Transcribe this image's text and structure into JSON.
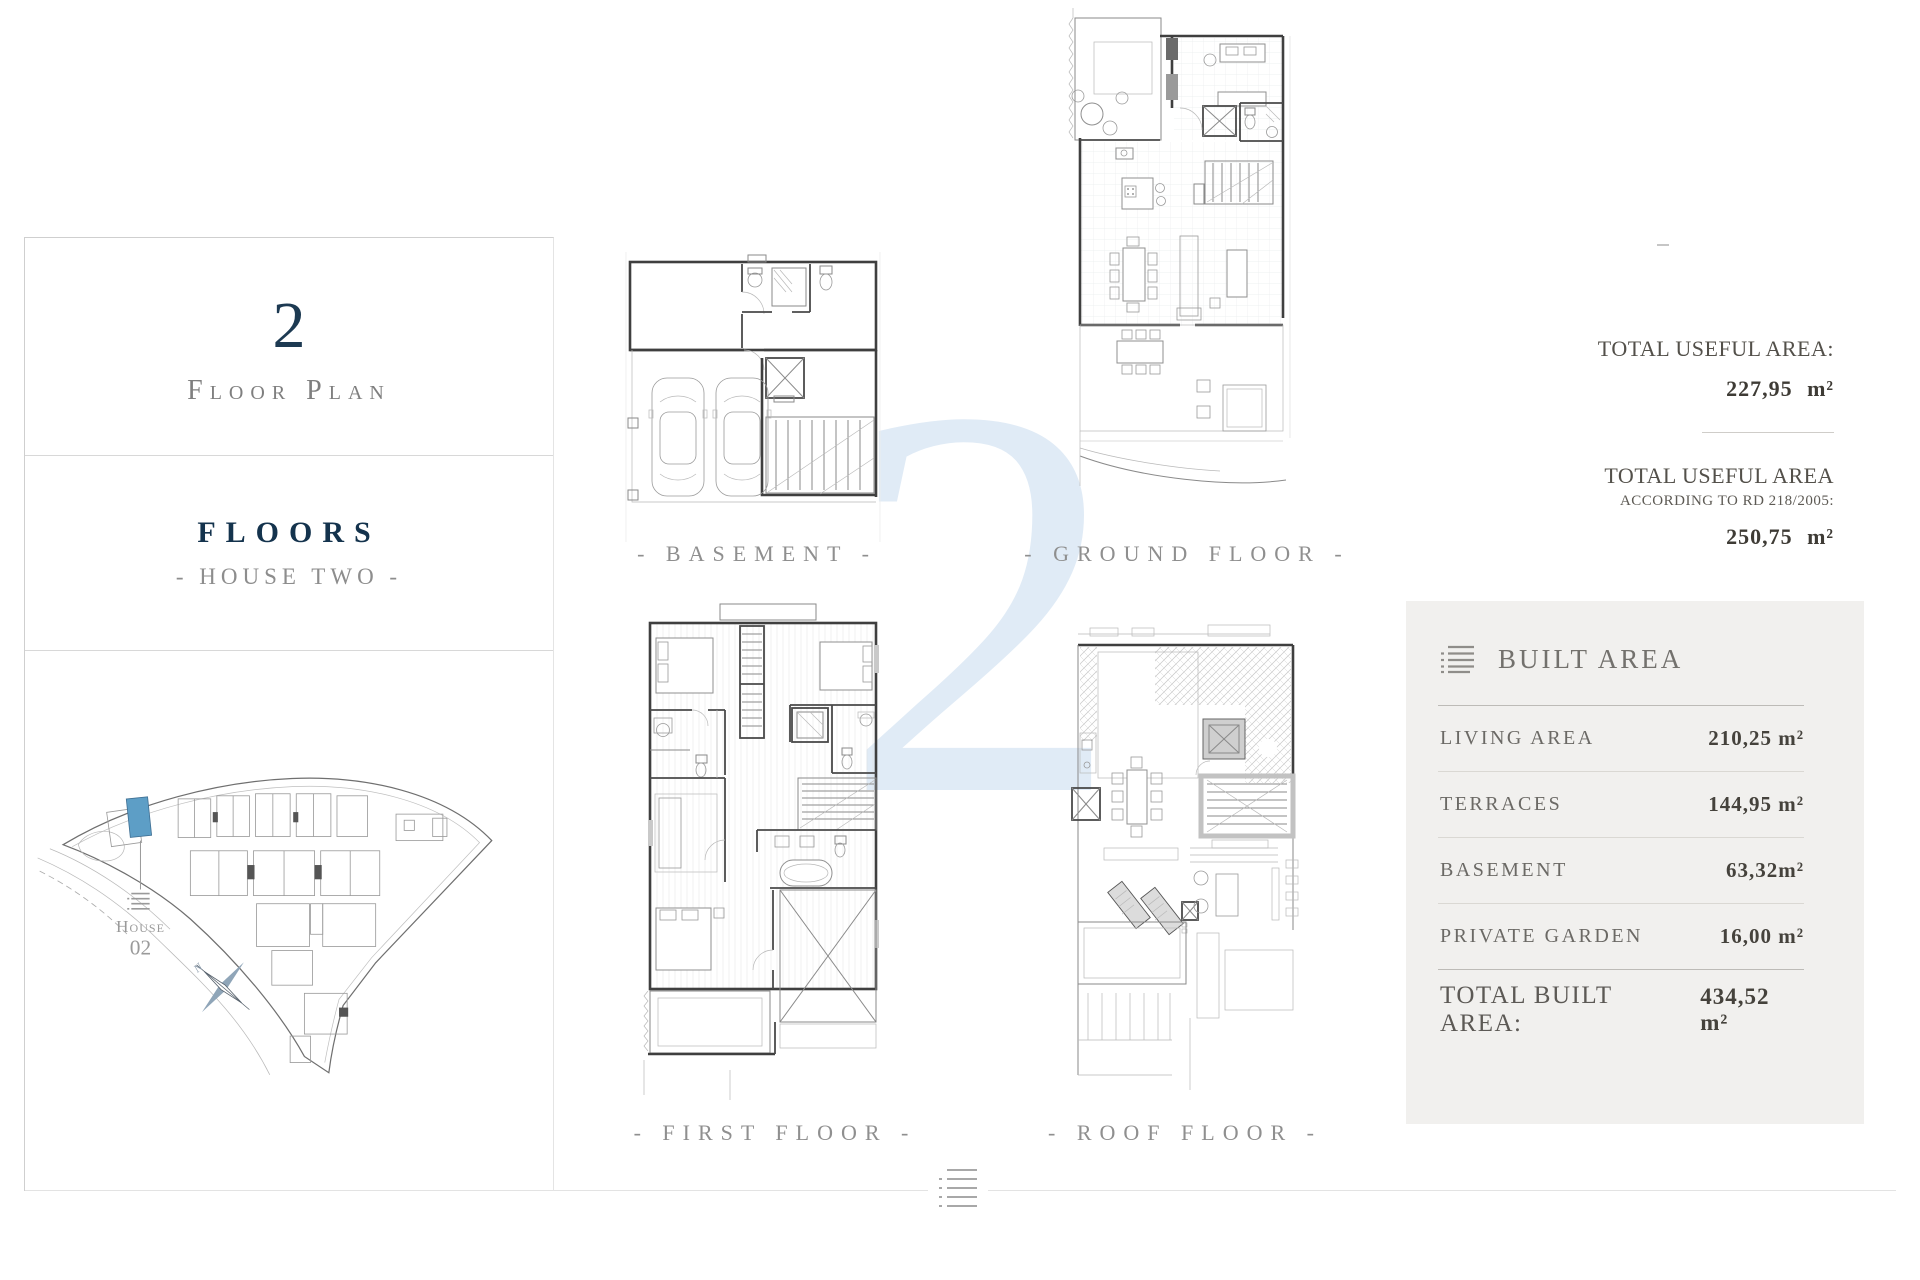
{
  "page": {
    "watermark": "2"
  },
  "sidebar": {
    "number": "2",
    "subtitle": "Floor Plan",
    "floors_title": "FLOORS",
    "floors_subtitle": "- HOUSE TWO -",
    "site": {
      "house_label": "House",
      "house_number": "02",
      "north": "N"
    }
  },
  "plans": [
    {
      "id": "basement",
      "label": "- BASEMENT -"
    },
    {
      "id": "ground",
      "label": "- GROUND FLOOR -"
    },
    {
      "id": "first",
      "label": "- FIRST FLOOR -"
    },
    {
      "id": "roof",
      "label": "- ROOF FLOOR -"
    }
  ],
  "stats": {
    "useful_area_label": "TOTAL USEFUL AREA:",
    "useful_area_value": "227,95 m²",
    "useful_rd_label": "TOTAL USEFUL AREA",
    "useful_rd_sublabel": "ACCORDING TO RD 218/2005:",
    "useful_rd_value": "250,75 m²"
  },
  "built_area": {
    "title": "BUILT AREA",
    "rows": [
      {
        "label": "LIVING AREA",
        "value": "210,25 m²"
      },
      {
        "label": "TERRACES",
        "value": "144,95 m²"
      },
      {
        "label": "BASEMENT",
        "value": "63,32m²"
      },
      {
        "label": "PRIVATE GARDEN",
        "value": "16,00 m²"
      }
    ],
    "total_label": "TOTAL BUILT AREA:",
    "total_value": "434,52 m²"
  },
  "colors": {
    "navy": "#1d3a52",
    "highlight_blue": "#5d9ec6",
    "watermark_blue": "#e0ebf6",
    "panel_gray": "#f1f0ee"
  }
}
